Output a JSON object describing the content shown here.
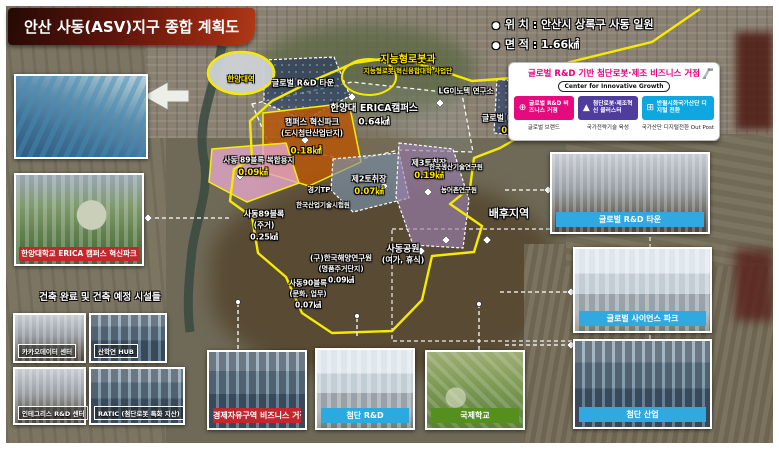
{
  "page": {
    "title": "안산 사동(ASV)지구 종합 계획도"
  },
  "meta": {
    "bullet": "●",
    "location": "위 치 : 안산시 상록구 사동 일원",
    "area": "면 적 : 1.66㎢"
  },
  "info_box": {
    "title": "글로벌 R&D 기반 첨단로봇·제조 비즈니스 거점",
    "subtitle": "Center for Innovative Growth",
    "pillars": [
      {
        "label": "글로벌 R&D 비즈니스 거점",
        "caption": "글로벌 브랜드",
        "color": "#e50a7e",
        "icon": "globe-icon",
        "icon_glyph": "⊕"
      },
      {
        "label": "첨단로봇·제조혁신 클러스터",
        "caption": "국가전략기술 육성",
        "color": "#4f3d9e",
        "icon": "robot-arm-icon",
        "icon_glyph": "▲"
      },
      {
        "label": "반월시화국가산단 디지털 전환",
        "caption": "국가산단 디지털전환 Out Post",
        "color": "#0fa7e0",
        "icon": "digital-icon",
        "icon_glyph": "⊞"
      }
    ]
  },
  "left_panel": {
    "campus_label": "한양대학교 ERICA 캠퍼스 혁신파크",
    "facilities_header": "건축 완료 및 건축 예정 시설들",
    "facilities": [
      "카카오데이터 센터",
      "산학연 HUB",
      "인테그리스 R&D 센터",
      "RATIC (첨단로봇 특화 지산)"
    ]
  },
  "bottom_photos": [
    {
      "label": "경제자유구역 비즈니스 거점",
      "color": "#c1272d"
    },
    {
      "label": "첨단 R&D",
      "color": "#29abe2"
    },
    {
      "label": "국제학교",
      "color": "#55901e"
    }
  ],
  "right_photos": [
    {
      "label": "글로벌 R&D 타운",
      "color": "#2fa9e0"
    },
    {
      "label": "글로벌 사이언스 파크",
      "color": "#2fa9e0"
    },
    {
      "label": "첨단 산업",
      "color": "#2fa9e0"
    }
  ],
  "map": {
    "robot_dept": {
      "title": "지능형로봇과",
      "subtitle": "지능형로봇 혁신융합대학 사업단"
    },
    "station": "한양대역",
    "zones": {
      "grd_town_nw": {
        "name": "글로벌 R&D 타운"
      },
      "lg_innotek": {
        "name": "LG이노텍 연구소"
      },
      "erica": {
        "name": "한양대 ERICA캠퍼스",
        "area": "0.64㎢"
      },
      "grd_town_e": {
        "name": "글로벌 R&D 타운",
        "area": "0.1㎢"
      },
      "campus_innopark": {
        "name": "캠퍼스 혁신파크",
        "sub": "(도시첨단산업단지)",
        "area": "0.18㎢"
      },
      "block89_mixed": {
        "name": "사동 89블록 복합용지",
        "area": "0.09㎢"
      },
      "gyeonggi_tp": {
        "name": "경기TP"
      },
      "ktl": {
        "name": "한국산업기술시험원"
      },
      "block89": {
        "name": "사동89블록",
        "sub": "(주거)",
        "area": "0.25㎢"
      },
      "pit2": {
        "name": "제2토취장",
        "area": "0.07㎢"
      },
      "pit3": {
        "name": "제3토취장",
        "area": "0.19㎢"
      },
      "kitech": {
        "name": "한국생산기술연구원"
      },
      "rri": {
        "name": "농어촌연구원"
      },
      "kordi": {
        "name": "(구)한국해양연구원",
        "sub": "(명품주거단지)",
        "area": "0.09㎢"
      },
      "block90": {
        "name": "사동90블록",
        "sub": "(문화, 업무)",
        "area": "0.07㎢"
      },
      "sadong_park": {
        "name": "사동공원",
        "sub": "(여가, 휴식)"
      },
      "hinterland": {
        "name": "배후지역"
      }
    }
  }
}
